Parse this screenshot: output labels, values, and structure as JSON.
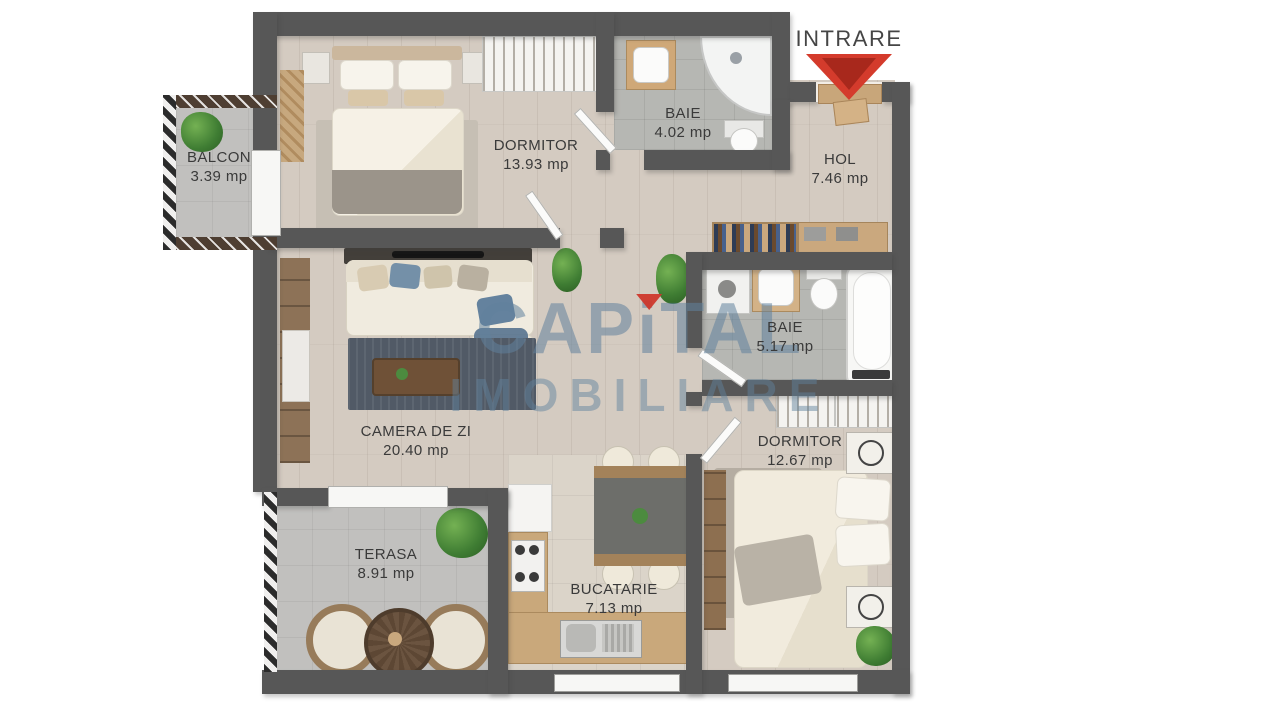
{
  "entrance": {
    "label": "INTRARE"
  },
  "brand": {
    "part1": "CAP",
    "accent_letter": "i",
    "part2": "TAL",
    "line2": "IMOBILIARE",
    "watermark_color": "#61829d",
    "accent_color": "#ce3428"
  },
  "rooms": [
    {
      "name": "BALCON",
      "area": "3.39 mp"
    },
    {
      "name": "DORMITOR",
      "area": "13.93 mp"
    },
    {
      "name": "BAIE",
      "area": "4.02 mp"
    },
    {
      "name": "HOL",
      "area": "7.46 mp"
    },
    {
      "name": "BAIE",
      "area": "5.17 mp"
    },
    {
      "name": "CAMERA DE ZI",
      "area": "20.40 mp"
    },
    {
      "name": "DORMITOR",
      "area": "12.67 mp"
    },
    {
      "name": "TERASA",
      "area": "8.91 mp"
    },
    {
      "name": "BUCATARIE",
      "area": "7.13 mp"
    }
  ],
  "colors": {
    "wall": "#575757",
    "wood_floor": "#d4cbc1",
    "bath_tile": "#b6b7b3",
    "concrete": "#c1c0be",
    "arrow_red": "#d43b2c"
  }
}
